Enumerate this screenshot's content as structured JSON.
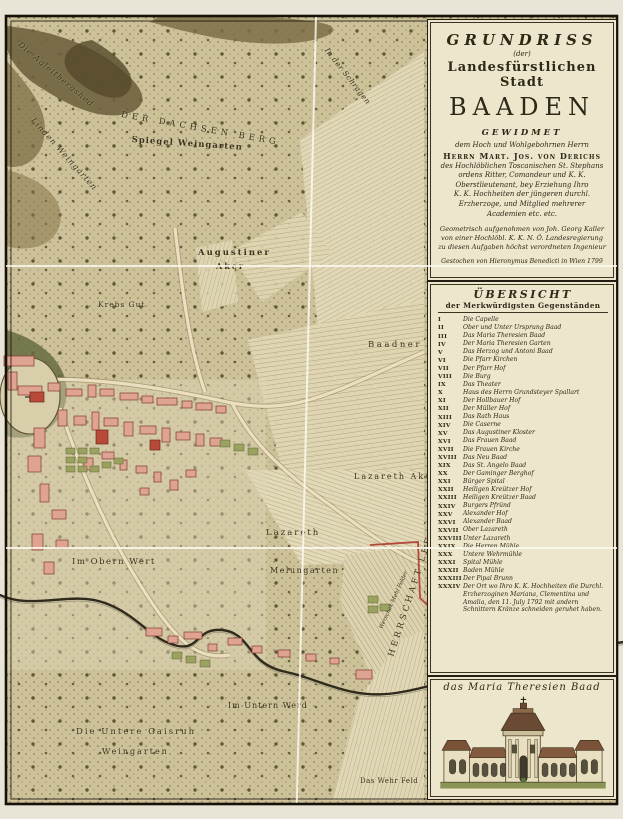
{
  "title_block": {
    "line1": "GRUNDRISS",
    "line2": "(der)",
    "line3": "Landesfürstlichen Stadt",
    "line4": "BAADEN",
    "line5": "GEWIDMET",
    "dedication": [
      "dem Hoch und Wohlgebohrnen Herrn",
      "Herrn Mart. Jos. von Derichs",
      "des Hochlöblichen Toscanischen St. Stephans",
      "ordens Ritter, Comandeur und K. K.",
      "Oberstlieutenant, bey Erziehung Ihro",
      "K. K. Hochheiten der jüngeren durchl.",
      "Erzherzoge, und Mitglied mehrerer",
      "Academien etc. etc.",
      "Geometrisch aufgenohmen von Joh. Georg Kaller",
      "von einer Hochlöbl. K. K. N. Ö. Landesregierung",
      "zu diesen Aufgaben höchst verordneten Ingenieur",
      "Gestochen von Hieronymus Benedicti in Wien 1799"
    ]
  },
  "legend": {
    "header1": "ÜBERSICHT",
    "header2": "der Merkwürdigsten Gegenständen",
    "items": [
      {
        "numeral": "I",
        "label": "Die Capelle"
      },
      {
        "numeral": "II",
        "label": "Ober und Unter Ursprung Baad"
      },
      {
        "numeral": "III",
        "label": "Das Maria Theresien Baad"
      },
      {
        "numeral": "IV",
        "label": "Der Maria Theresien Garten"
      },
      {
        "numeral": "V",
        "label": "Das Herzog und Antoni Baad"
      },
      {
        "numeral": "VI",
        "label": "Die Pfarr Kirchen"
      },
      {
        "numeral": "VII",
        "label": "Der Pfarr Hof"
      },
      {
        "numeral": "VIII",
        "label": "Die Burg"
      },
      {
        "numeral": "IX",
        "label": "Das Theater"
      },
      {
        "numeral": "X",
        "label": "Haus des Herrn Grundsteyer Spallart"
      },
      {
        "numeral": "XI",
        "label": "Der Hollbauer Hof"
      },
      {
        "numeral": "XII",
        "label": "Der Müller Hof"
      },
      {
        "numeral": "XIII",
        "label": "Das Rath Haus"
      },
      {
        "numeral": "XIV",
        "label": "Die Caserne"
      },
      {
        "numeral": "XV",
        "label": "Das Augustiner Kloster"
      },
      {
        "numeral": "XVI",
        "label": "Das Frauen Baad"
      },
      {
        "numeral": "XVII",
        "label": "Die Frauen Kirche"
      },
      {
        "numeral": "XVIII",
        "label": "Das Neu Baad"
      },
      {
        "numeral": "XIX",
        "label": "Das St. Angelo Baad"
      },
      {
        "numeral": "XX",
        "label": "Der Gaminger Berghof"
      },
      {
        "numeral": "XXI",
        "label": "Bürger Spital"
      },
      {
        "numeral": "XXII",
        "label": "Heiligen Kreützer Hof"
      },
      {
        "numeral": "XXIII",
        "label": "Heiligen Kreützer Baad"
      },
      {
        "numeral": "XXIV",
        "label": "Burgers Pfründ"
      },
      {
        "numeral": "XXV",
        "label": "Alexander Hof"
      },
      {
        "numeral": "XXVI",
        "label": "Alexander Baad"
      },
      {
        "numeral": "XXVII",
        "label": "Ober Lazareth"
      },
      {
        "numeral": "XXVIII",
        "label": "Unter Lazareth"
      },
      {
        "numeral": "XXIX",
        "label": "Die Herren Mühle"
      },
      {
        "numeral": "XXX",
        "label": "Untere Wehrmühle"
      },
      {
        "numeral": "XXXI",
        "label": "Spital Mühle"
      },
      {
        "numeral": "XXXII",
        "label": "Baden Mühle"
      },
      {
        "numeral": "XXXIII",
        "label": "Der Pipal Brunn"
      },
      {
        "numeral": "XXXIV",
        "label": "Der Ort wo Ihro K. K. Hochheiten die Durchl. Erzherzoginen Mariana, Clementina und Amalia, den 11. July 1792 mit andern Schnittern Kränze schneiden geruhet haben."
      }
    ]
  },
  "vignette": {
    "caption": "das Maria Theresien Baad"
  },
  "map_labels": {
    "agleitberg": "Die Agleitbergshed",
    "linden": "Linden Weingarten",
    "dachsenberg": "DER DACHSEN BERG",
    "spiegel": "Spiegel Weingarten",
    "schragen": "In der Schragen",
    "augustiner1": "Augustiner",
    "augustiner2": "Aker",
    "krebsgut": "Krebs Gut",
    "baadnerfeld": "Baadner Feld",
    "lazarethaker": "Lazareth Aker",
    "lazareth": "Lazareth",
    "melungarten": "Melungarten",
    "obernwert": "Im Obern Wert",
    "unternwerd": "Im Untern Werd",
    "gaisruh1": "Die Untere Gaisruh",
    "gaisruh2": "Weingarten",
    "wehrfeld": "Das Wehr Feld",
    "leesdorf": "HERRSCHAFT LEESDORF",
    "mehlfelder": "Werschak Mehl Felder"
  },
  "colors": {
    "parchment": "#cfc49d",
    "field": "#e2d9ba",
    "hill": "#71643e",
    "building_pink": "#dfa392",
    "building_red": "#b84a3a",
    "garden_green": "#9ba15f",
    "ink": "#2e2817",
    "panel_bg": "#ece6cd",
    "boundary_red": "#b5493c",
    "river": "#2f2a1c"
  }
}
